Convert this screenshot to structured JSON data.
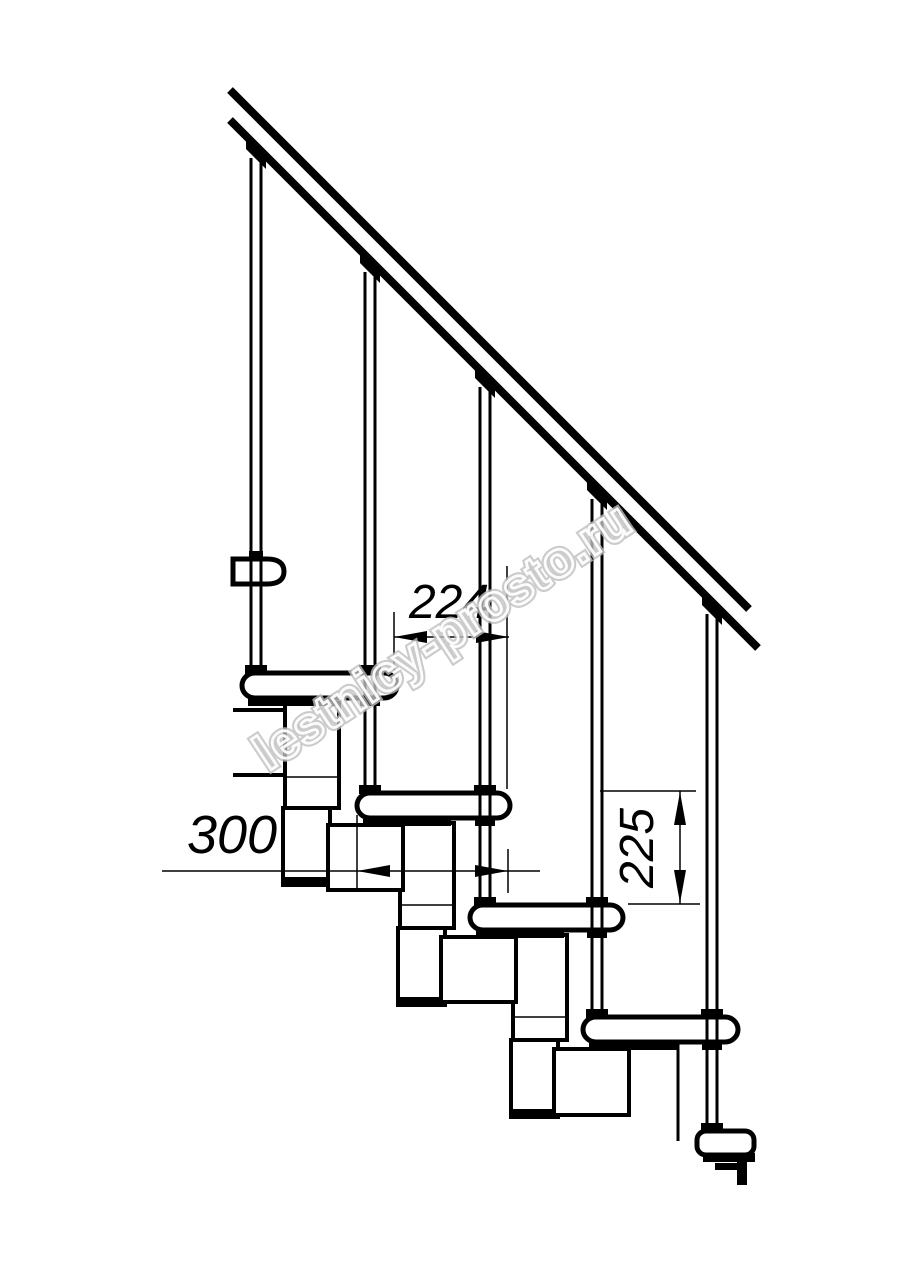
{
  "drawing": {
    "title": "modular-staircase-side-view",
    "dimensions": {
      "step_run": "224",
      "tread_depth": "300",
      "step_rise": "225"
    },
    "watermark": "lestnicy-prosto.ru",
    "colors": {
      "line": "#000000",
      "background": "#ffffff",
      "watermark_outline": "#bfbfbf"
    }
  }
}
